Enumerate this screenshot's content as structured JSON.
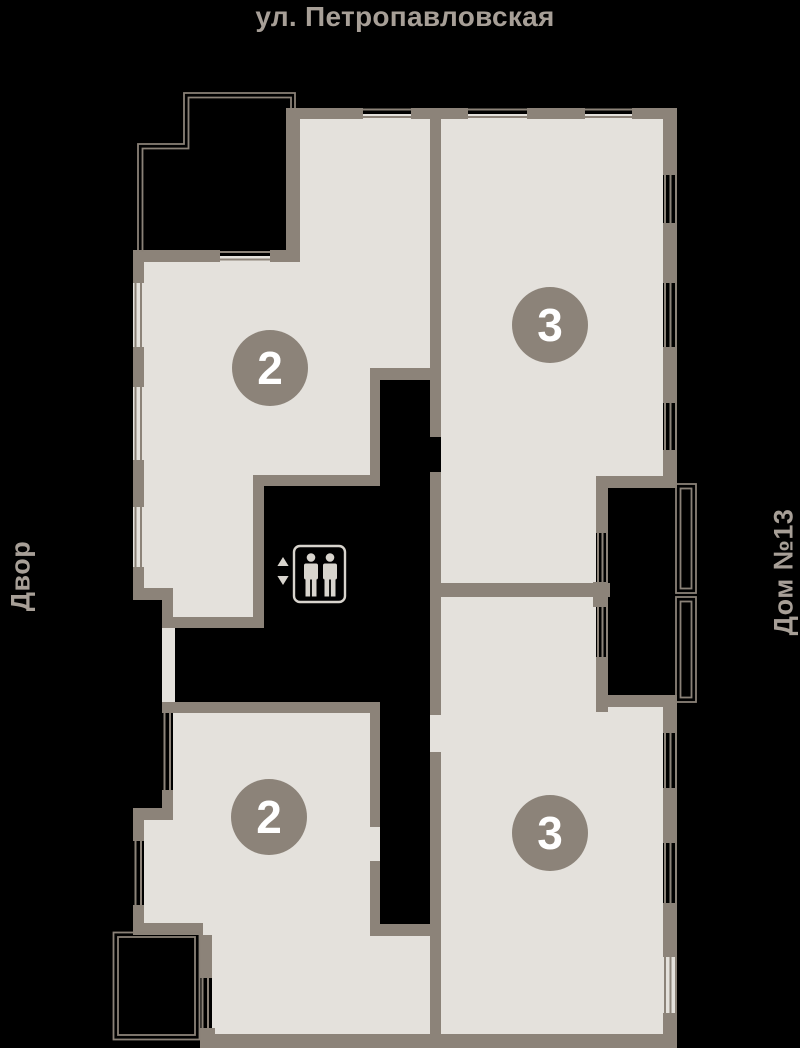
{
  "plan": {
    "street_label": "ул. Петропавловская",
    "left_label": "Двор",
    "right_label": "Дом №13"
  },
  "apartments": [
    {
      "name": "apartment-top-left",
      "rooms_badge": "2"
    },
    {
      "name": "apartment-top-right",
      "rooms_badge": "3"
    },
    {
      "name": "apartment-bottom-left",
      "rooms_badge": "2"
    },
    {
      "name": "apartment-bottom-right",
      "rooms_badge": "3"
    }
  ],
  "icons": {
    "elevator": "elevator-people-icon",
    "up_arrow": "up-triangle-icon",
    "down_arrow": "down-triangle-icon"
  },
  "colors": {
    "background": "#000000",
    "floor": "#e4e1dc",
    "wall": "#8c8379",
    "badge": "#8c8379",
    "badge_text": "#ffffff",
    "label_text": "#a79f97",
    "elevator_outline": "#d8d4cd"
  }
}
